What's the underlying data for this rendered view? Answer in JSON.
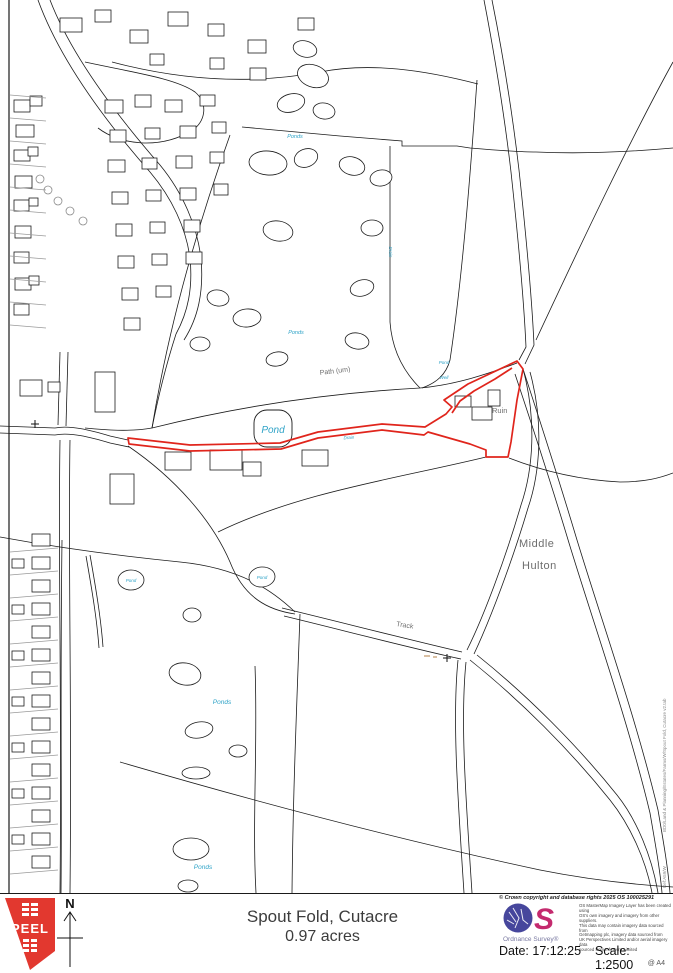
{
  "map_labels": [
    {
      "t": "Ponds"
    },
    {
      "t": "Ponds"
    },
    {
      "t": "Pond"
    },
    {
      "t": "Drain"
    },
    {
      "t": "Drain"
    },
    {
      "t": "Pond"
    },
    {
      "t": "Well"
    },
    {
      "t": "Ruin"
    },
    {
      "t": "Path (um)"
    },
    {
      "t": "Track"
    },
    {
      "t": "Middle"
    },
    {
      "t": "Hulton"
    },
    {
      "t": "Pond"
    },
    {
      "t": "Pond"
    },
    {
      "t": "Ponds"
    },
    {
      "t": "Ponds"
    }
  ],
  "margin": {
    "file_ref": "BD0/Land & Planning/Estates/Farms/W/Spout Fold, Cutacre v2.tab",
    "ref": "Ref:A59/W"
  },
  "footer": {
    "peel": "PEEL",
    "north": "N",
    "title_line1": "Spout Fold, Cutacre",
    "title_line2": "0.97 acres",
    "copyright": "© Crown copyright and database rights 2025 OS 100025291",
    "os_name": "Ordnance Survey®",
    "disclaimer": [
      "OS MasterMap Imagery Layer has been created using",
      "OS's own imagery and imagery from other suppliers.",
      "This data may contain imagery data sourced from",
      "Getmapping plc, imagery data sourced from",
      "UK Perspectives Limited and/or aerial imagery data",
      "sourced from InfoTerra Limited"
    ],
    "date_label": "Date:",
    "date_value": "17:12:25",
    "scale_label": "Scale:",
    "scale_value": "1:2500",
    "paper": "@ A4"
  }
}
